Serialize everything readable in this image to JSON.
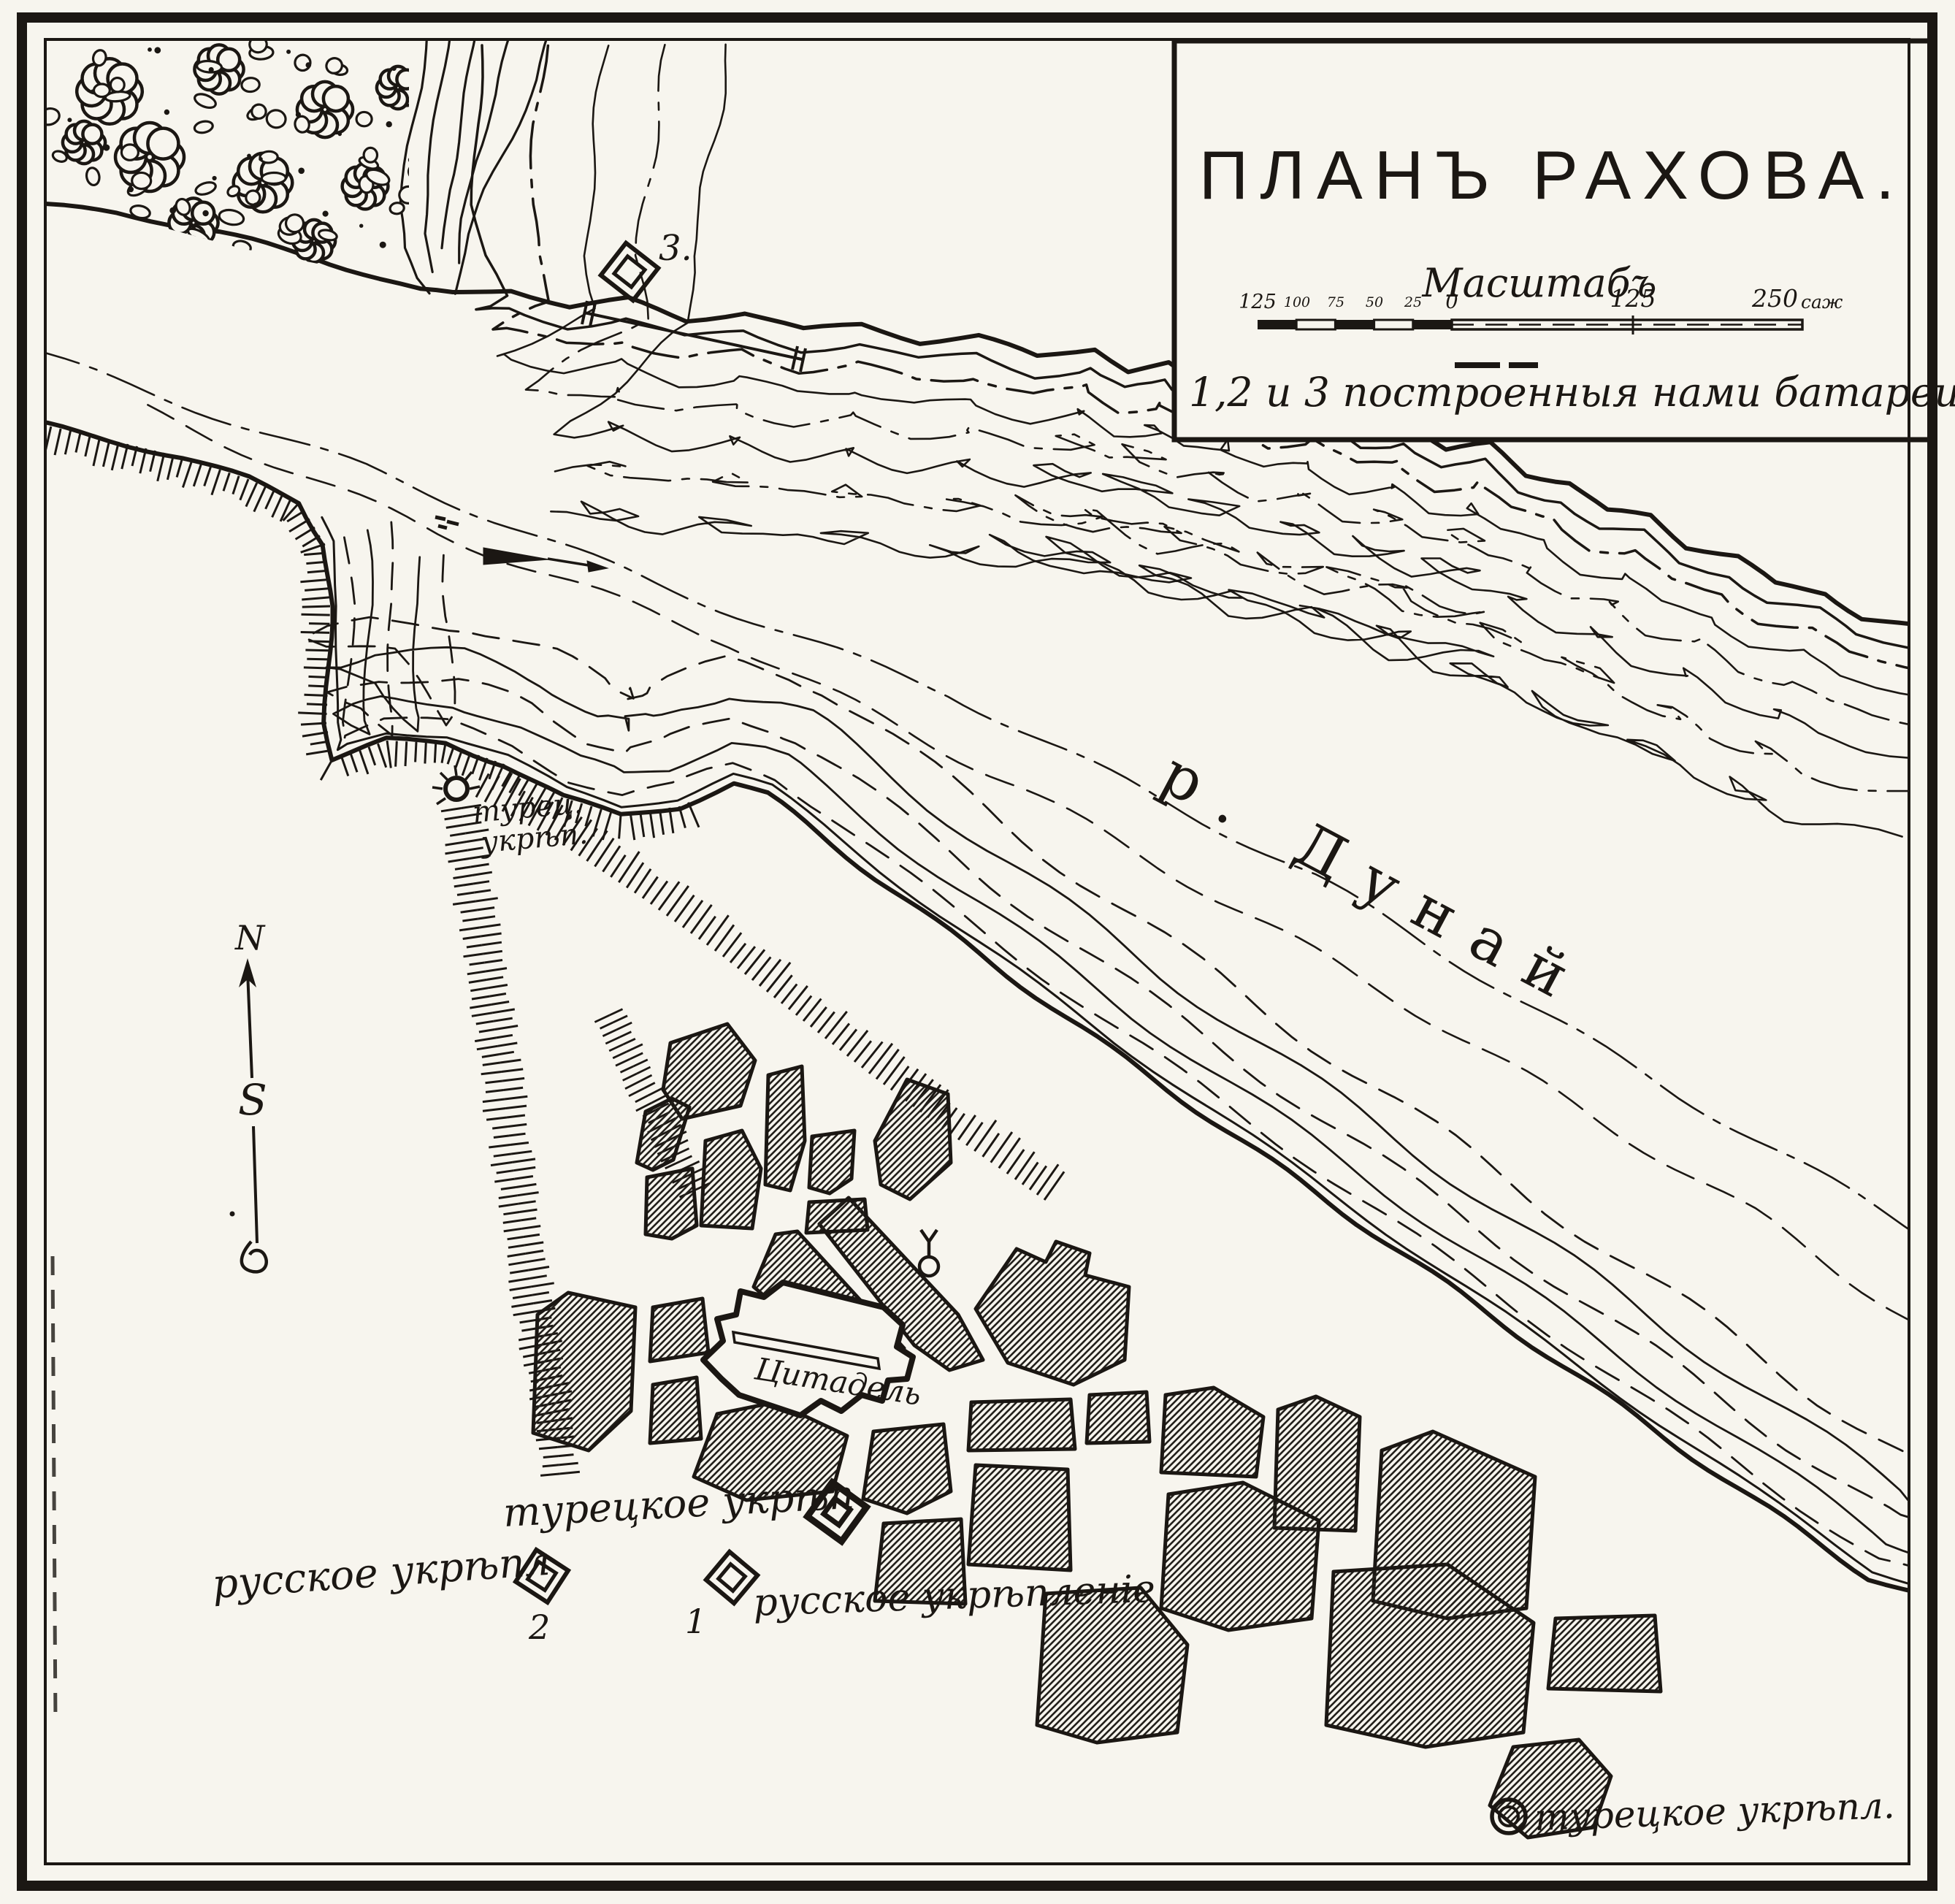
{
  "map": {
    "title": "ПЛАНЪ РАХОВА.",
    "scale": {
      "heading": "Масштабъ",
      "ticks": [
        "125",
        "100",
        "75",
        "50",
        "25",
        "0",
        "125",
        "250"
      ],
      "unit": "саж"
    },
    "legend": "1,2 и 3 построенныя нами батареи",
    "river_label": "р. Дунай",
    "citadel_label": "Цитадель",
    "forts": {
      "ravine_line1": "турец.",
      "ravine_line2": "укрѣп.",
      "turkish_center": "турецкое укрѣп",
      "russian_left": "русское укрѣпл",
      "russian_center": "русское укрѣпленіе",
      "turkish_southeast": "турецкое укрѣпл."
    },
    "batteries": {
      "b1": "1",
      "b2": "2",
      "b3": "3."
    },
    "compass": {
      "north": "N",
      "south": "S"
    },
    "colors": {
      "ink": "#1b1713",
      "paper": "#f7f5ee"
    }
  }
}
